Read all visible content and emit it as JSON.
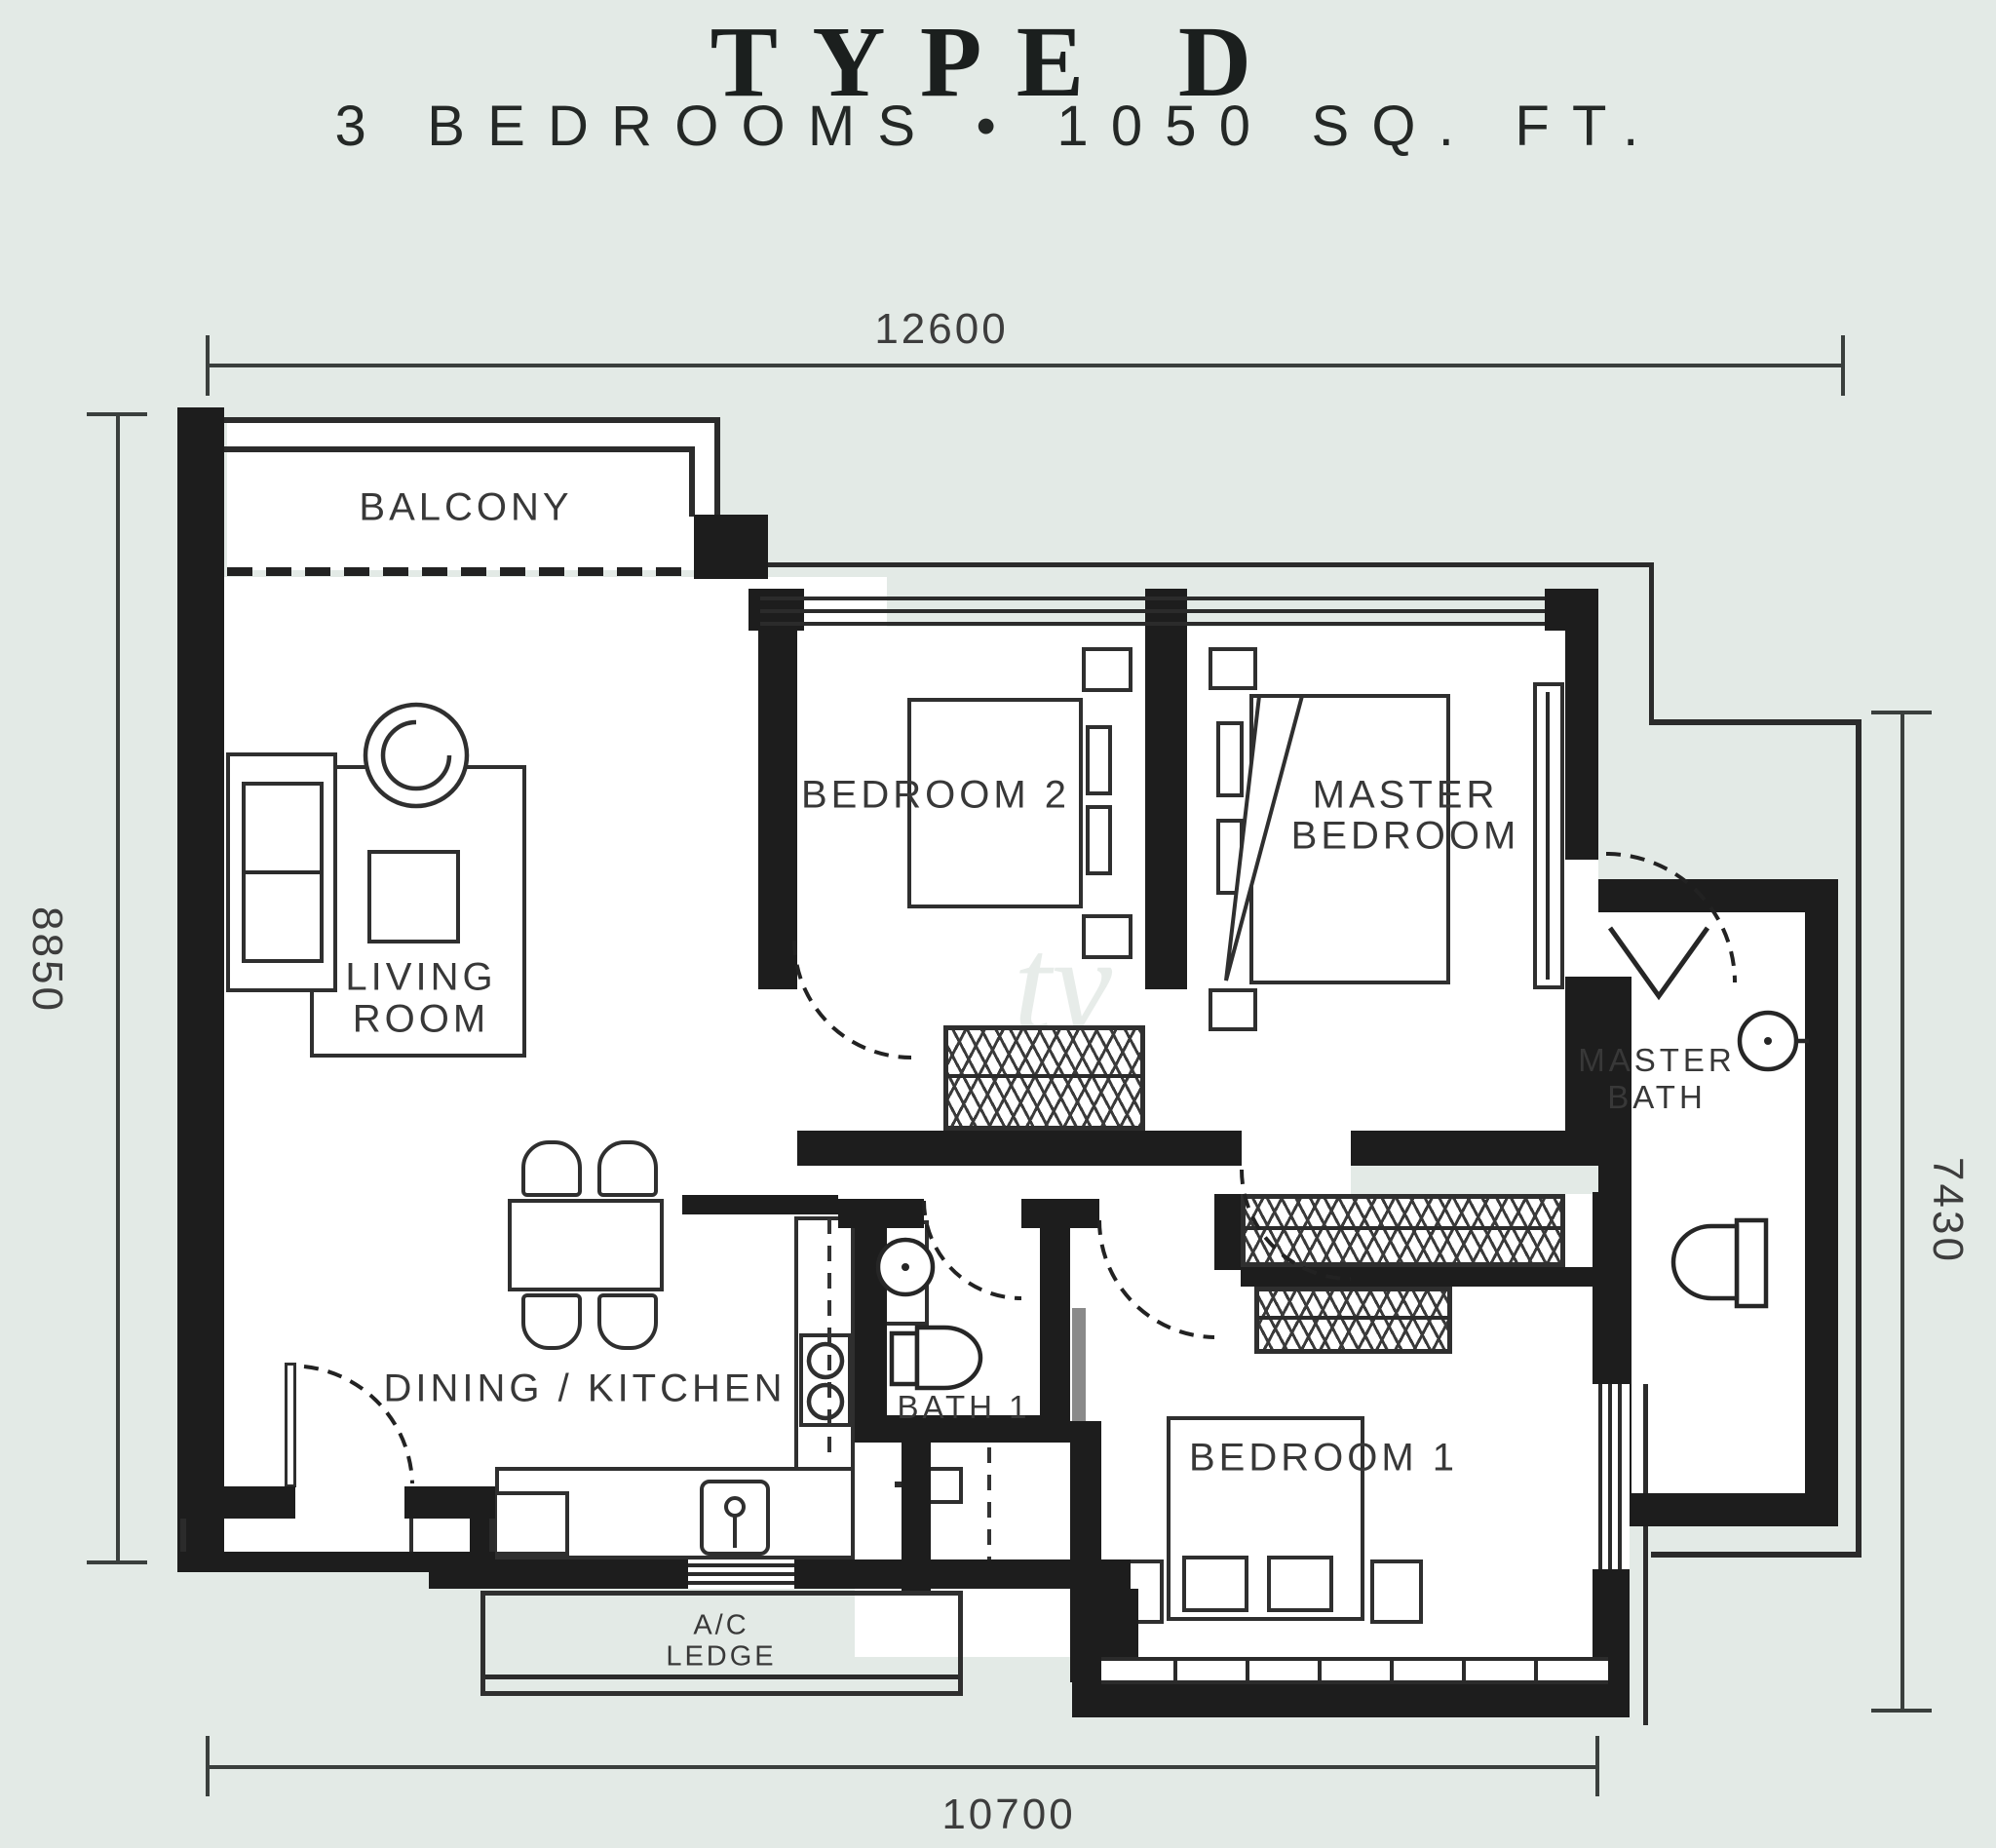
{
  "title": "TYPE D",
  "subtitle": "3 BEDROOMS • 1050 SQ. FT.",
  "dimensions": {
    "top_width": "12600",
    "left_height": "8850",
    "right_height": "7430",
    "bottom_width": "10700"
  },
  "rooms": {
    "balcony": "BALCONY",
    "living_line1": "LIVING",
    "living_line2": "ROOM",
    "bedroom2": "BEDROOM 2",
    "master_line1": "MASTER",
    "master_line2": "BEDROOM",
    "masterbath_line1": "MASTER",
    "masterbath_line2": "BATH",
    "dining": "DINING / KITCHEN",
    "bath1": "BATH 1",
    "bedroom1": "BEDROOM 1",
    "ac_line1": "A/C",
    "ac_line2": "LEDGE"
  },
  "colors": {
    "background": "#e3eae6",
    "wall": "#1d1d1d",
    "line": "#2b2b2b",
    "label": "#383838"
  }
}
